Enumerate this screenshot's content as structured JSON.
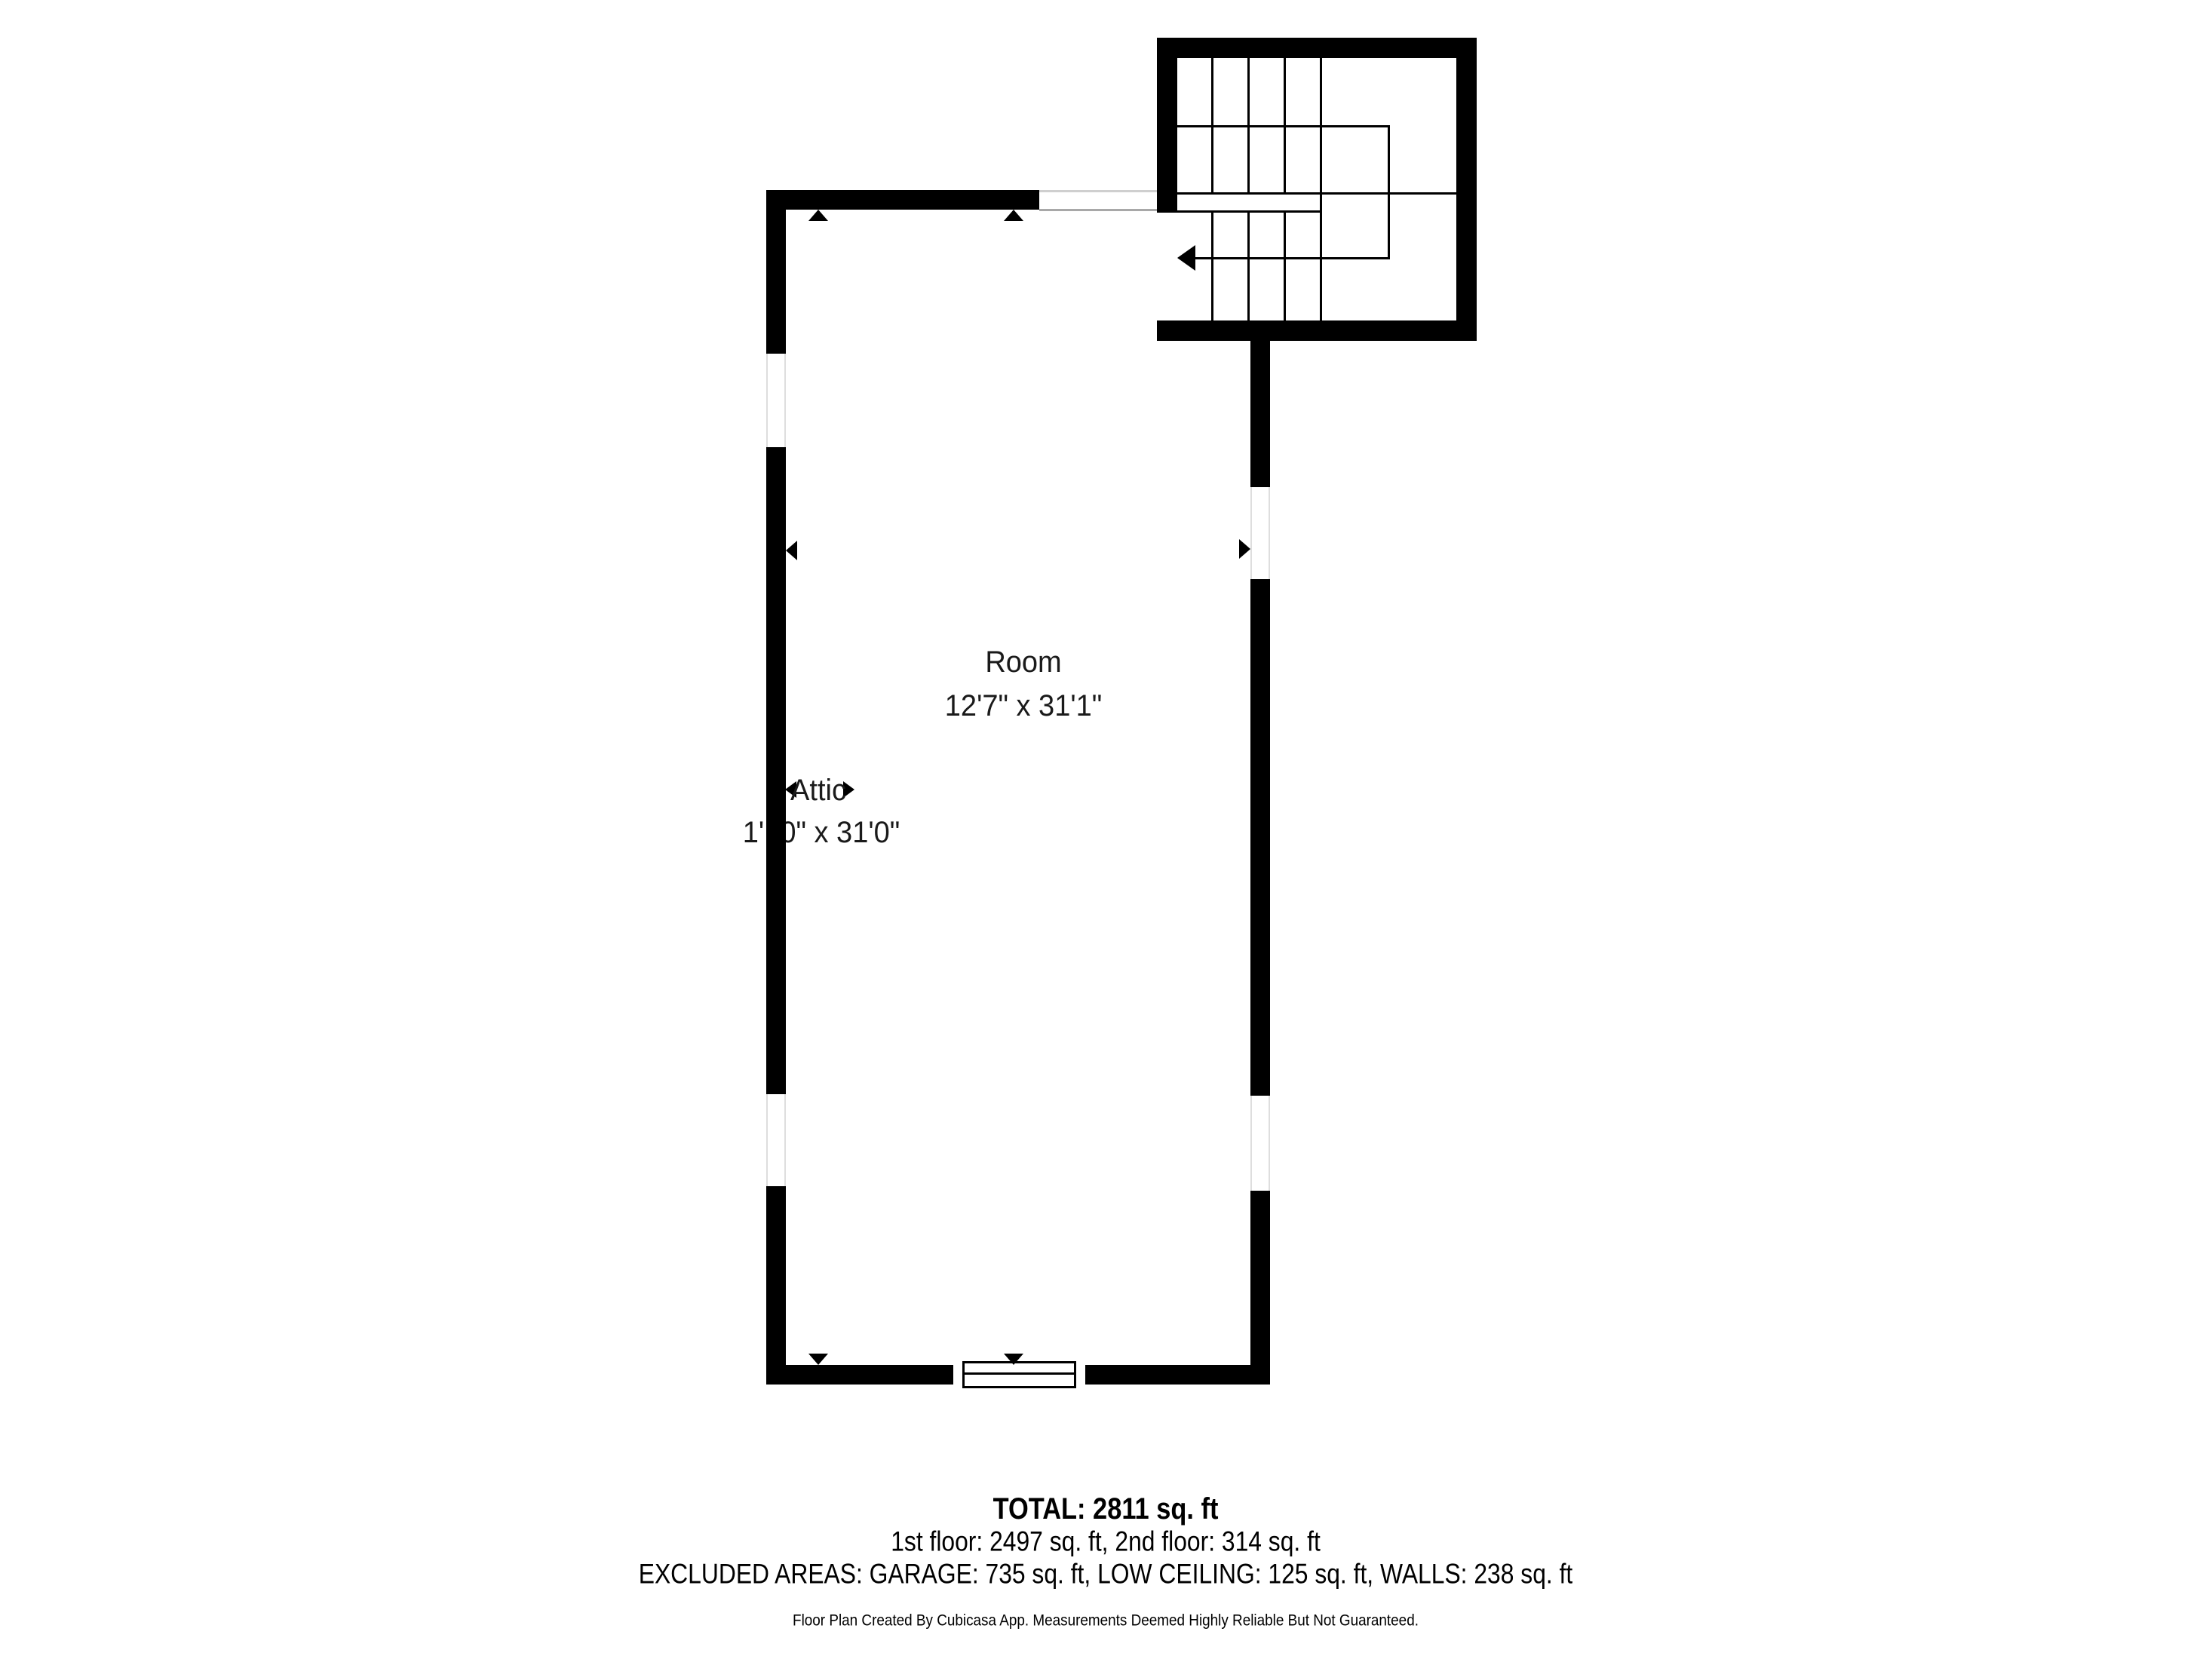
{
  "plan": {
    "rooms": [
      {
        "name": "Room",
        "dimensions": "12'7\" x 31'1\""
      },
      {
        "name": "Attic",
        "dimensions": "1'10\" x 31'0\""
      }
    ],
    "icons": {
      "dimension_marker": "filled-triangle",
      "stair_direction_arrow": "left-filled-arrow"
    },
    "colors": {
      "wall": "#000000",
      "background": "#ffffff",
      "label_text": "#1a1a1a",
      "opening_line": "#cfcfcf"
    }
  },
  "summary": {
    "total": "TOTAL: 2811 sq. ft",
    "floors": "1st floor: 2497 sq. ft, 2nd floor: 314 sq. ft",
    "excluded": "EXCLUDED AREAS: GARAGE: 735 sq. ft, LOW CEILING: 125 sq. ft, WALLS: 238 sq. ft",
    "disclaimer": "Floor Plan Created By Cubicasa App. Measurements Deemed Highly Reliable But Not Guaranteed."
  }
}
